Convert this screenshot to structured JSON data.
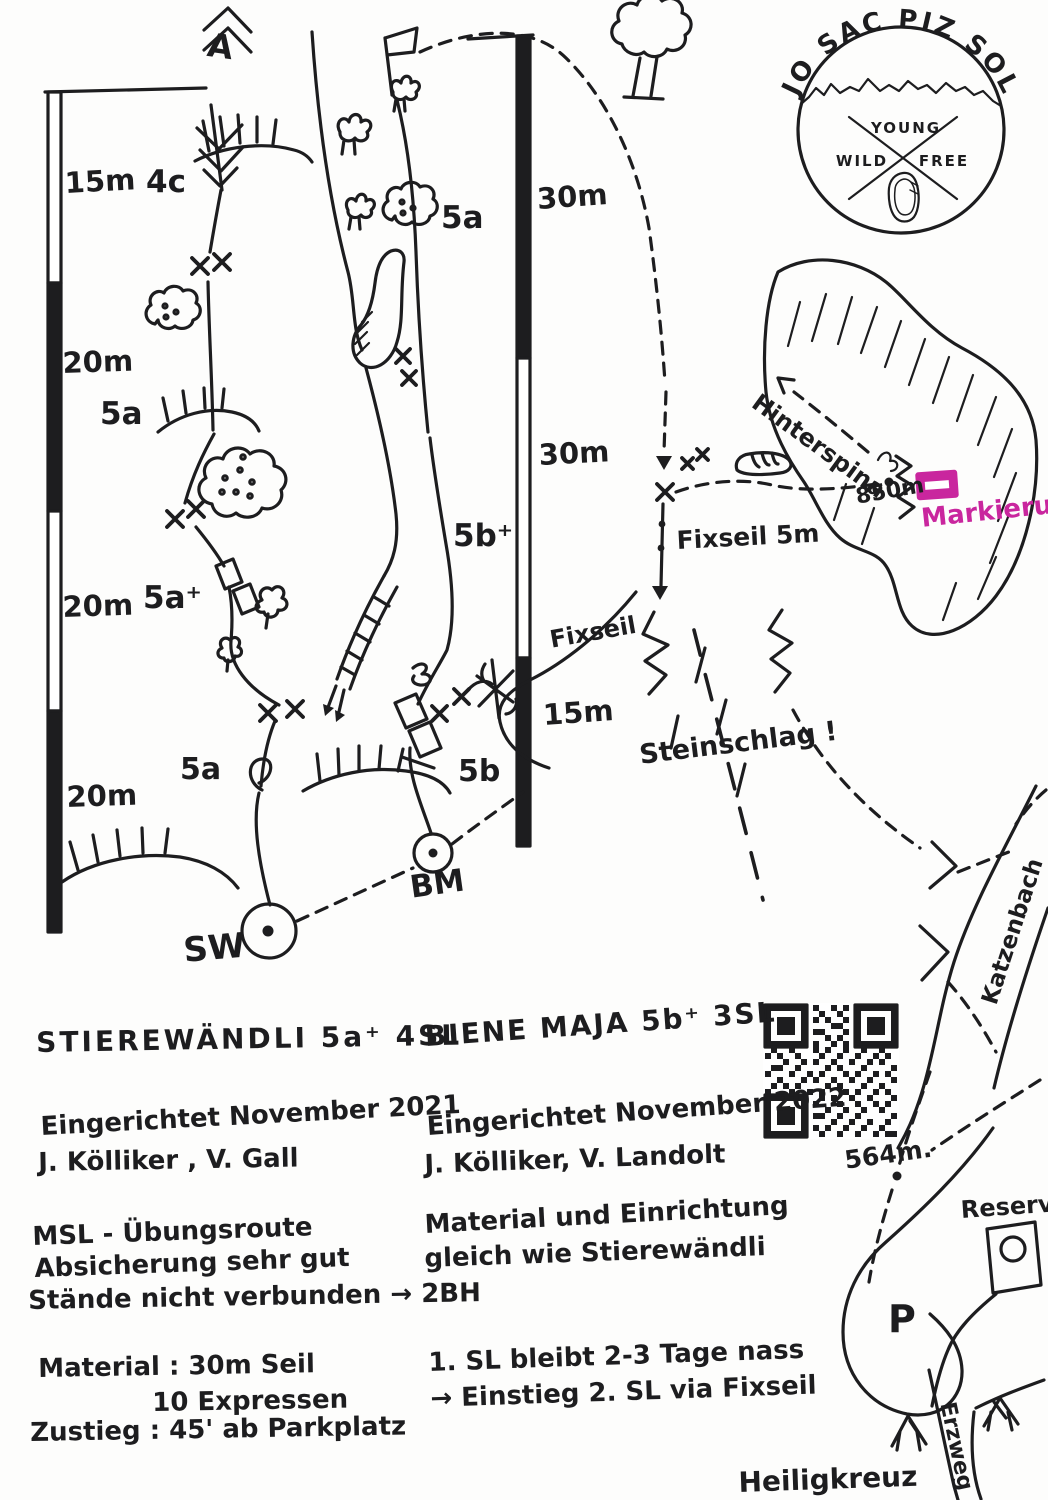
{
  "colors": {
    "ink": "#1d1d1f",
    "pink": "#c9269e"
  },
  "logo": {
    "arc": "JO SAC PIZ SOL",
    "young": "YOUNG",
    "wild": "WILD",
    "free": "FREE"
  },
  "scales": {
    "left": [
      "15m",
      "20m",
      "20m",
      "20m"
    ],
    "right": [
      "30m",
      "30m",
      "15m"
    ]
  },
  "grades": {
    "l4": "4c",
    "l3": "5a",
    "l2": "5a⁺",
    "l1": "5a",
    "m3": "5a",
    "m2": "5b⁺",
    "m1": "5b"
  },
  "marks": {
    "a_top": "A",
    "sw": "SW",
    "bm": "BM",
    "p": "P"
  },
  "map": {
    "fixseil5": "Fixseil 5m",
    "fixseil": "Fixseil",
    "steinschlag": "Steinschlag !",
    "hinterspina": "Hinterspina",
    "e850": "850m",
    "markierung": "Markierung",
    "e564": "564m.",
    "katzenbach": "Katzenbach",
    "reservoir": "Reservoir",
    "erzweg": "Erzweg",
    "heiligkreuz": "Heiligkreuz"
  },
  "left_route": {
    "title": "STIEREWÄNDLI 5a⁺ 4SL",
    "est": "Eingerichtet November 2021",
    "team": "J. Kölliker , V. Gall",
    "n1": "MSL - Übungsroute",
    "n2": "Absicherung sehr gut",
    "n3": "Stände nicht verbunden → 2BH",
    "m1": "Material : 30m Seil",
    "m2": "10 Expressen",
    "m3": "Zustieg : 45' ab Parkplatz"
  },
  "right_route": {
    "title": "BIENE MAJA 5b⁺ 3SL",
    "est": "Eingerichtet November 2022",
    "team": "J. Kölliker, V. Landolt",
    "n1": "Material und Einrichtung",
    "n2": "gleich wie Stierewändli",
    "w1": "1. SL bleibt 2-3 Tage nass",
    "w2": "→ Einstieg 2. SL via Fixseil"
  }
}
